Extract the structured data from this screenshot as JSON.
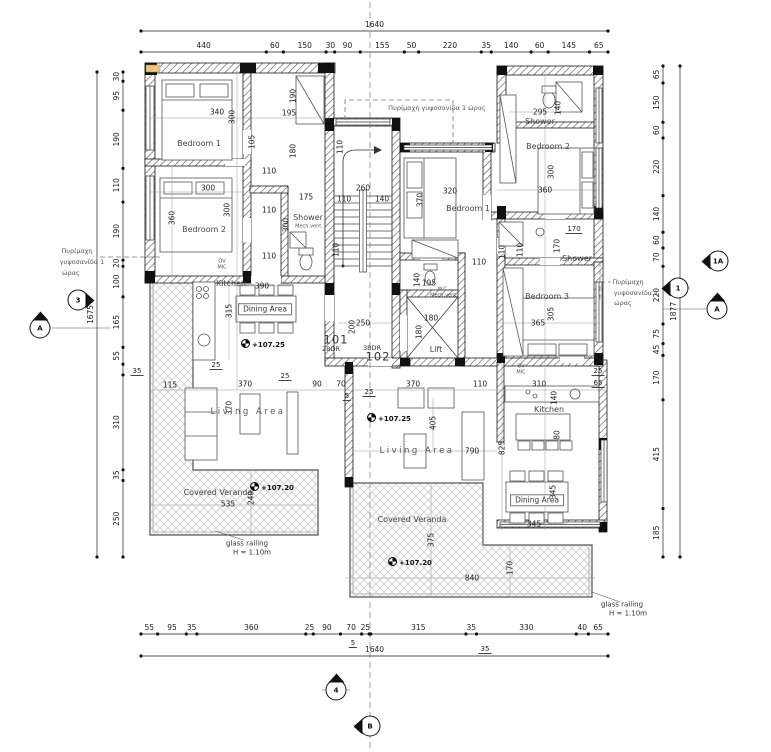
{
  "drawing_type": "architectural floor plan",
  "colors": {
    "paper": "#ffffff",
    "ink": "#1a1a1a",
    "wall_hatch": "#666666",
    "veranda_hatch": "#c9c9c4",
    "fire_board_tan": "#e9c489"
  },
  "units": {
    "left": {
      "number": "101",
      "bedrooms": "2BDR"
    },
    "right": {
      "number": "102",
      "bedrooms": "3BDR"
    }
  },
  "labels": [
    {
      "t": "340",
      "x": 217,
      "y": 112
    },
    {
      "t": "300",
      "x": 232,
      "y": 117,
      "v": 1
    },
    {
      "t": "105",
      "x": 252,
      "y": 142,
      "v": 1
    },
    {
      "t": "190",
      "x": 293,
      "y": 96,
      "v": 1
    },
    {
      "t": "195",
      "x": 289,
      "y": 113
    },
    {
      "t": "180",
      "x": 293,
      "y": 151,
      "v": 1
    },
    {
      "t": "110",
      "x": 269,
      "y": 171
    },
    {
      "t": "175",
      "x": 306,
      "y": 197
    },
    {
      "t": "110",
      "x": 269,
      "y": 210
    },
    {
      "t": "300",
      "x": 286,
      "y": 225,
      "v": 1
    },
    {
      "t": "110",
      "x": 269,
      "y": 256
    },
    {
      "t": "300",
      "x": 208,
      "y": 188
    },
    {
      "t": "360",
      "x": 172,
      "y": 218,
      "v": 1
    },
    {
      "t": "300",
      "x": 227,
      "y": 210,
      "v": 1
    },
    {
      "t": "110",
      "x": 340,
      "y": 147,
      "v": 1
    },
    {
      "t": "260",
      "x": 363,
      "y": 188
    },
    {
      "t": "110",
      "x": 344,
      "y": 199
    },
    {
      "t": "140",
      "x": 382,
      "y": 199
    },
    {
      "t": "110",
      "x": 336,
      "y": 250,
      "v": 1
    },
    {
      "t": "Bedroom 1",
      "x": 199,
      "y": 144,
      "c": "room"
    },
    {
      "t": "Bedroom 2",
      "x": 204,
      "y": 230,
      "c": "room"
    },
    {
      "t": "Kitchen",
      "x": 231,
      "y": 284,
      "c": "room"
    },
    {
      "t": "OV",
      "x": 222,
      "y": 262,
      "c": "tiny"
    },
    {
      "t": "MIC",
      "x": 222,
      "y": 268,
      "c": "tiny"
    },
    {
      "t": "390",
      "x": 262,
      "y": 286
    },
    {
      "t": "Dining Area",
      "x": 265,
      "y": 309,
      "c": "boxed"
    },
    {
      "t": "315",
      "x": 229,
      "y": 311,
      "v": 1
    },
    {
      "t": "+107.25",
      "x": 263,
      "y": 344,
      "c": "level"
    },
    {
      "t": "25",
      "x": 216,
      "y": 366,
      "c": "flag"
    },
    {
      "t": "115",
      "x": 170,
      "y": 385
    },
    {
      "t": "25",
      "x": 285,
      "y": 377,
      "c": "flag"
    },
    {
      "t": "370",
      "x": 245,
      "y": 384
    },
    {
      "t": "90",
      "x": 317,
      "y": 384
    },
    {
      "t": "70",
      "x": 341,
      "y": 384
    },
    {
      "t": "5",
      "x": 347,
      "y": 397,
      "c": "flag"
    },
    {
      "t": "25",
      "x": 369,
      "y": 393,
      "c": "flag"
    },
    {
      "t": "370",
      "x": 413,
      "y": 384
    },
    {
      "t": "110",
      "x": 480,
      "y": 384
    },
    {
      "t": "310",
      "x": 539,
      "y": 384
    },
    {
      "t": "25",
      "x": 598,
      "y": 372,
      "c": "flag"
    },
    {
      "t": "65",
      "x": 598,
      "y": 384,
      "c": "flag"
    },
    {
      "t": "370",
      "x": 229,
      "y": 408,
      "v": 1
    },
    {
      "t": "Living Area",
      "x": 248,
      "y": 412,
      "c": "spread"
    },
    {
      "t": "Covered Veranda",
      "x": 218,
      "y": 493,
      "c": "room"
    },
    {
      "t": "535",
      "x": 228,
      "y": 504
    },
    {
      "t": "240",
      "x": 251,
      "y": 498,
      "v": 1
    },
    {
      "t": "+107.20",
      "x": 272,
      "y": 487,
      "c": "level"
    },
    {
      "t": "glass railing",
      "x": 247,
      "y": 544,
      "c": "rail"
    },
    {
      "t": "H = 1.10m",
      "x": 252,
      "y": 553,
      "c": "rail"
    },
    {
      "t": "Shower",
      "x": 308,
      "y": 218,
      "c": "room"
    },
    {
      "t": "Mech.vent.",
      "x": 309,
      "y": 227,
      "c": "tiny"
    },
    {
      "t": "101",
      "x": 336,
      "y": 340,
      "c": "big"
    },
    {
      "t": "2BDR",
      "x": 331,
      "y": 349,
      "c": "sm"
    },
    {
      "t": "3BDR",
      "x": 372,
      "y": 348,
      "c": "sm"
    },
    {
      "t": "102",
      "x": 378,
      "y": 357,
      "c": "big"
    },
    {
      "t": "250",
      "x": 363,
      "y": 323
    },
    {
      "t": "200",
      "x": 352,
      "y": 327,
      "v": 1
    },
    {
      "t": "195",
      "x": 429,
      "y": 283
    },
    {
      "t": "140",
      "x": 417,
      "y": 280,
      "v": 1
    },
    {
      "t": "W.C.",
      "x": 443,
      "y": 290,
      "c": "tiny"
    },
    {
      "t": "Mech.vent.",
      "x": 444,
      "y": 296,
      "c": "tiny"
    },
    {
      "t": "180",
      "x": 431,
      "y": 318
    },
    {
      "t": "180",
      "x": 419,
      "y": 332,
      "v": 1
    },
    {
      "t": "Lift",
      "x": 436,
      "y": 350,
      "c": "room"
    },
    {
      "t": "Bedroom 1",
      "x": 468,
      "y": 209,
      "c": "room"
    },
    {
      "t": "320",
      "x": 450,
      "y": 191
    },
    {
      "t": "370",
      "x": 420,
      "y": 200,
      "v": 1
    },
    {
      "t": "110",
      "x": 479,
      "y": 262
    },
    {
      "t": "110",
      "x": 502,
      "y": 252,
      "v": 1
    },
    {
      "t": "Πυρίμαχη γυψοσανίδα 1 ώρας",
      "x": 437,
      "y": 108,
      "c": "ann"
    },
    {
      "t": "Shower",
      "x": 540,
      "y": 122,
      "c": "room"
    },
    {
      "t": "295",
      "x": 540,
      "y": 112
    },
    {
      "t": "140",
      "x": 558,
      "y": 108,
      "v": 1
    },
    {
      "t": "Bedroom 2",
      "x": 548,
      "y": 147,
      "c": "room"
    },
    {
      "t": "300",
      "x": 551,
      "y": 172,
      "v": 1
    },
    {
      "t": "360",
      "x": 545,
      "y": 190
    },
    {
      "t": "170",
      "x": 574,
      "y": 230,
      "c": "flag"
    },
    {
      "t": "110",
      "x": 520,
      "y": 250,
      "v": 1
    },
    {
      "t": "170",
      "x": 557,
      "y": 246,
      "v": 1
    },
    {
      "t": "Shower",
      "x": 577,
      "y": 259,
      "c": "room"
    },
    {
      "t": "Bedroom 3",
      "x": 547,
      "y": 297,
      "c": "room"
    },
    {
      "t": "305",
      "x": 551,
      "y": 314,
      "v": 1
    },
    {
      "t": "365",
      "x": 538,
      "y": 323
    },
    {
      "t": "OV",
      "x": 521,
      "y": 367,
      "c": "tiny"
    },
    {
      "t": "MIC",
      "x": 521,
      "y": 373,
      "c": "tiny"
    },
    {
      "t": "Kitchen",
      "x": 549,
      "y": 410,
      "c": "room"
    },
    {
      "t": "140",
      "x": 554,
      "y": 398,
      "v": 1
    },
    {
      "t": "80",
      "x": 557,
      "y": 435,
      "v": 1
    },
    {
      "t": "825",
      "x": 502,
      "y": 448,
      "v": 1
    },
    {
      "t": "Dining Area",
      "x": 537,
      "y": 500,
      "c": "boxed"
    },
    {
      "t": "345",
      "x": 553,
      "y": 492,
      "v": 1
    },
    {
      "t": "345",
      "x": 534,
      "y": 524
    },
    {
      "t": "+107.25",
      "x": 389,
      "y": 418,
      "c": "level"
    },
    {
      "t": "405",
      "x": 433,
      "y": 423,
      "v": 1
    },
    {
      "t": "790",
      "x": 472,
      "y": 451
    },
    {
      "t": "Living Area",
      "x": 417,
      "y": 451,
      "c": "spread"
    },
    {
      "t": "Covered Veranda",
      "x": 412,
      "y": 520,
      "c": "room"
    },
    {
      "t": "375",
      "x": 431,
      "y": 540,
      "v": 1
    },
    {
      "t": "840",
      "x": 472,
      "y": 578
    },
    {
      "t": "170",
      "x": 510,
      "y": 568,
      "v": 1
    },
    {
      "t": "+107.20",
      "x": 410,
      "y": 562,
      "c": "level"
    },
    {
      "t": "glass railing",
      "x": 622,
      "y": 605,
      "c": "rail"
    },
    {
      "t": "H = 1.10m",
      "x": 628,
      "y": 614,
      "c": "rail"
    },
    {
      "t": "Πυρίμαχη",
      "x": 77,
      "y": 251,
      "c": "ann"
    },
    {
      "t": "γυψοσανίδα 1",
      "x": 82,
      "y": 262,
      "c": "ann"
    },
    {
      "t": "ώρας",
      "x": 71,
      "y": 273,
      "c": "ann"
    },
    {
      "t": "Πυρίμαχη",
      "x": 628,
      "y": 282,
      "c": "ann"
    },
    {
      "t": "γυψοσανίδα 1",
      "x": 636,
      "y": 293,
      "c": "ann"
    },
    {
      "t": "ώρας",
      "x": 623,
      "y": 303,
      "c": "ann"
    },
    {
      "t": "5",
      "x": 353,
      "y": 644,
      "c": "flag"
    },
    {
      "t": "35",
      "x": 485,
      "y": 650,
      "c": "flag"
    },
    {
      "t": "35",
      "x": 137,
      "y": 372,
      "c": "flag"
    }
  ],
  "section_markers": [
    {
      "t": "3",
      "x": 78,
      "y": 300,
      "d": "right"
    },
    {
      "t": "A",
      "x": 40,
      "y": 328,
      "d": "up"
    },
    {
      "t": "1A",
      "x": 718,
      "y": 261,
      "d": "left"
    },
    {
      "t": "1",
      "x": 678,
      "y": 288,
      "d": "left"
    },
    {
      "t": "A",
      "x": 717,
      "y": 309,
      "d": "up"
    },
    {
      "t": "4",
      "x": 336,
      "y": 690,
      "d": "up"
    },
    {
      "t": "B",
      "x": 370,
      "y": 726,
      "d": "left"
    }
  ],
  "dim_chains": [
    {
      "o": "h",
      "x1": 141,
      "x2": 608,
      "y": 31,
      "labels": [
        "1640"
      ],
      "segments": [
        1640
      ]
    },
    {
      "o": "h",
      "x1": 141,
      "x2": 608,
      "y": 52,
      "labels": [
        "440",
        "60",
        "150",
        "30",
        "90",
        "155",
        "50",
        "220",
        "35",
        "140",
        "60",
        "145",
        "65"
      ],
      "segments": [
        440,
        60,
        150,
        30,
        90,
        155,
        50,
        220,
        35,
        140,
        60,
        145,
        65
      ]
    },
    {
      "o": "h",
      "x1": 141,
      "x2": 608,
      "y": 634,
      "labels": [
        "55",
        "95",
        "35",
        "360",
        "25",
        "90",
        "70",
        "25",
        "",
        "315",
        "35",
        "330",
        "40",
        "65"
      ],
      "segments": [
        55,
        95,
        35,
        360,
        25,
        90,
        70,
        25,
        5,
        315,
        35,
        330,
        40,
        65
      ]
    },
    {
      "o": "h",
      "x1": 141,
      "x2": 608,
      "y": 656,
      "labels": [
        "1640"
      ],
      "segments": [
        1640
      ]
    },
    {
      "o": "v",
      "x": 123,
      "y1": 72,
      "y2": 557,
      "labels": [
        "30",
        "95",
        "190",
        "110",
        "190",
        "20",
        "100",
        "165",
        "55",
        "",
        "310",
        "35",
        "250"
      ],
      "segments": [
        30,
        95,
        190,
        110,
        190,
        20,
        100,
        165,
        55,
        35,
        310,
        35,
        250
      ]
    },
    {
      "o": "v",
      "x": 97,
      "y1": 72,
      "y2": 557,
      "labels": [
        "1675"
      ],
      "segments": [
        1675
      ]
    },
    {
      "o": "v",
      "x": 663,
      "y1": 66,
      "y2": 557,
      "labels": [
        "65",
        "150",
        "60",
        "220",
        "140",
        "60",
        "70",
        "220",
        "75",
        "45",
        "170",
        "415",
        "185"
      ],
      "segments": [
        65,
        150,
        60,
        220,
        140,
        60,
        70,
        220,
        75,
        45,
        170,
        415,
        185
      ]
    },
    {
      "o": "v",
      "x": 680,
      "y1": 66,
      "y2": 557,
      "labels": [
        "1877"
      ],
      "segments": [
        1877
      ]
    }
  ]
}
